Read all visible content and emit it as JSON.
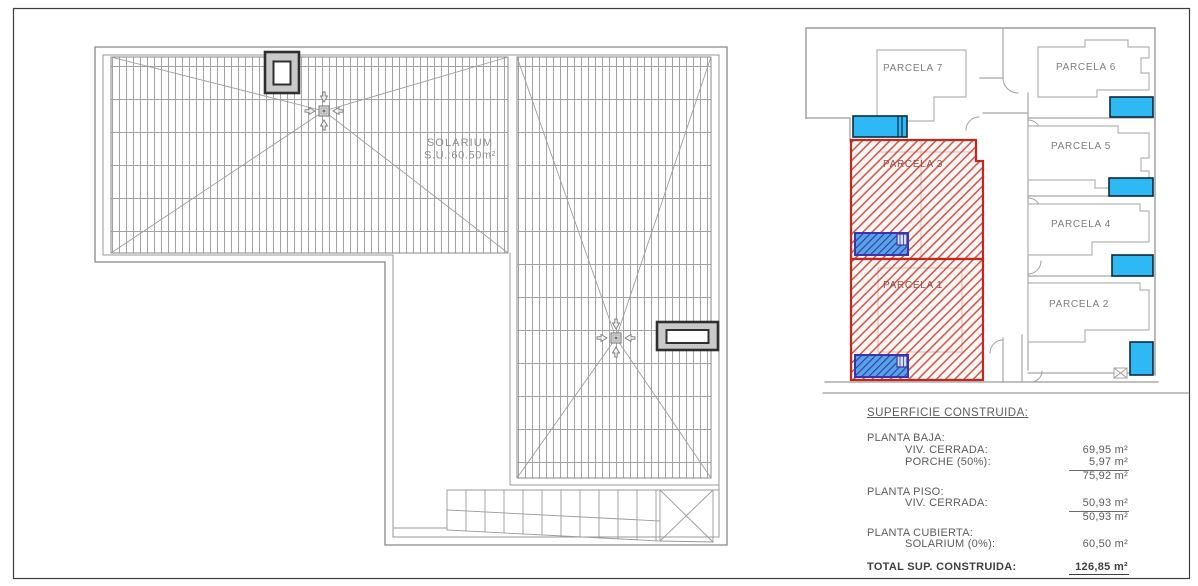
{
  "roof_plan": {
    "solarium_label": "SOLARIUM",
    "solarium_area": "S.U.:60.50m²"
  },
  "site_plan": {
    "parcels": [
      {
        "label": "PARCELA 7",
        "highlighted": false
      },
      {
        "label": "PARCELA 6",
        "highlighted": false
      },
      {
        "label": "PARCELA 5",
        "highlighted": false
      },
      {
        "label": "PARCELA 4",
        "highlighted": false
      },
      {
        "label": "PARCELA 3",
        "highlighted": true
      },
      {
        "label": "PARCELA 2",
        "highlighted": false
      },
      {
        "label": "PARCELA 1",
        "highlighted": true
      }
    ],
    "colors": {
      "parcel_highlight": "#c2281c",
      "pool_water": "#2eb8f4",
      "hatched_pool_water": "#55a5e6"
    }
  },
  "summary": {
    "title": "SUPERFICIE CONSTRUIDA:",
    "planta_baja": {
      "label": "PLANTA BAJA:",
      "rows": [
        {
          "label": "VIV. CERRADA:",
          "value": "69,95 m²"
        },
        {
          "label": "PORCHE (50%):",
          "value": "5,97 m²"
        }
      ],
      "subtotal": "75,92 m²"
    },
    "planta_piso": {
      "label": "PLANTA PISO:",
      "rows": [
        {
          "label": "VIV. CERRADA:",
          "value": "50,93 m²"
        }
      ],
      "subtotal": "50,93 m²"
    },
    "planta_cubierta": {
      "label": "PLANTA CUBIERTA:",
      "rows": [
        {
          "label": "SOLARIUM (0%):",
          "value": "60,50 m²"
        }
      ]
    },
    "total": {
      "label": "TOTAL SUP. CONSTRUIDA:",
      "value": "126,85 m²"
    }
  }
}
